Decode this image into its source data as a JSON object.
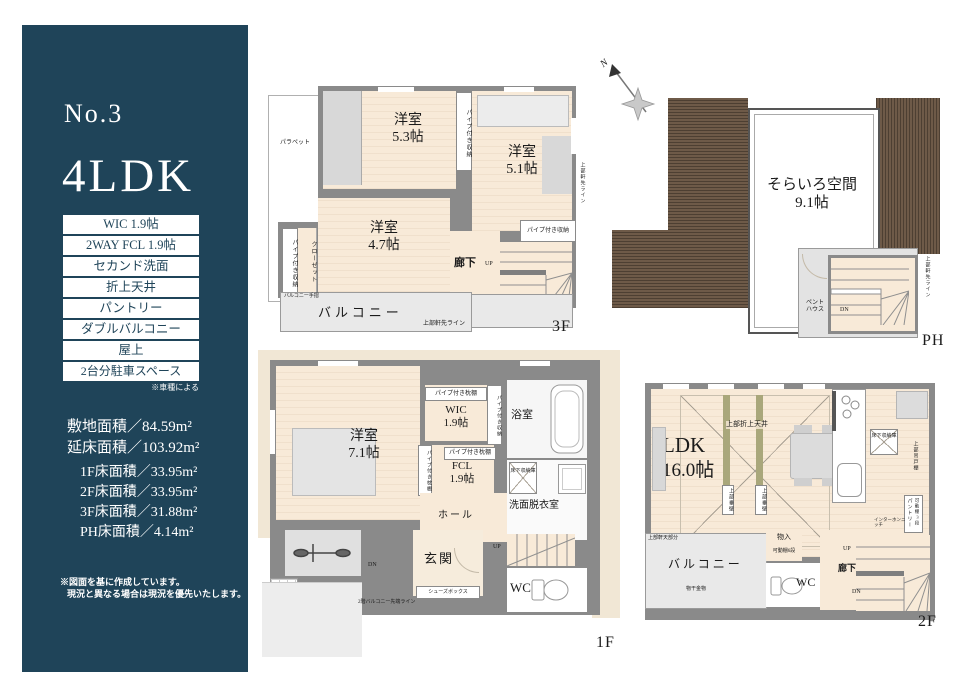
{
  "colors": {
    "sidebar_bg": "#1f4459",
    "room_floor": "#f8ead8",
    "wall_gray": "#8a8a8a",
    "balcony_gray": "#e9e9e9",
    "roof_brown": "#6e5a48",
    "accent_olive": "#a9a77b"
  },
  "sidebar": {
    "number": "No.3",
    "plan_type": "4LDK",
    "features": [
      "WIC 1.9帖",
      "2WAY FCL 1.9帖",
      "セカンド洗面",
      "折上天井",
      "パントリー",
      "ダブルバルコニー",
      "屋上",
      "2台分駐車スペース"
    ],
    "feature_note": "※車種による",
    "site_area": "敷地面積／84.59m²",
    "total_area": "延床面積／103.92m²",
    "floor_areas": [
      "1F床面積／33.95m²",
      "2F床面積／33.95m²",
      "3F床面積／31.88m²",
      "PH床面積／4.14m²"
    ],
    "disclaimer1": "※図面を基に作成しています。",
    "disclaimer2": "現況と異なる場合は現況を優先いたします。"
  },
  "plan3f": {
    "title": "3F",
    "room_53_name": "洋室",
    "room_53_size": "5.3帖",
    "room_51_name": "洋室",
    "room_51_size": "5.1帖",
    "room_47_name": "洋室",
    "room_47_size": "4.7帖",
    "parapet": "パラペット",
    "balcony": "バルコニー",
    "balcony_rail": "バルコニー手摺",
    "hallway": "廊下",
    "pipe_storage": "パイプ付き収納",
    "closet": "クローゼット",
    "eaves_line": "上部軒先ライン",
    "up": "UP",
    "dn": "DN"
  },
  "planph": {
    "title": "PH",
    "north": "N",
    "sky_name": "そらいろ空間",
    "sky_size": "9.1帖",
    "penthouse_1": "ペント",
    "penthouse_2": "ハウス",
    "eaves_line": "上部軒先ライン",
    "dn": "DN"
  },
  "plan1f": {
    "title": "1F",
    "room_71_name": "洋室",
    "room_71_size": "7.1帖",
    "wic_name": "WIC",
    "wic_size": "1.9帖",
    "fcl_name": "FCL",
    "fcl_size": "1.9帖",
    "bath": "浴室",
    "washroom": "洗面脱衣室",
    "hall": "ホール",
    "entrance": "玄関",
    "wc": "WC",
    "shoe_box": "シューズボックス",
    "pillow_shelf": "パイプ付き枕棚",
    "pipe_storage": "パイプ付き収納",
    "underfloor": "床下収納庫",
    "balcony_tip_line": "2階バルコニー先端ライン",
    "up": "UP",
    "dn": "DN"
  },
  "plan2f": {
    "title": "2F",
    "ldk_name": "LDK",
    "ldk_size": "16.0帖",
    "coffered": "上部折上天井",
    "hanging_wall": "上部垂壁",
    "underfloor": "床下収納庫",
    "cupboard": "上部吊戸棚",
    "pantry": "パントリー",
    "shelf3": "可動棚3段",
    "intercom": "インターホンニッチ",
    "balcony": "バルコニー",
    "laundry": "物干金物",
    "eaves_soffit": "上部軒天部分",
    "closet": "物入",
    "shelf6": "可動棚6段",
    "wc": "WC",
    "second_basin": "セカンド洗面",
    "hallway": "廊下",
    "up": "UP",
    "dn": "DN"
  }
}
